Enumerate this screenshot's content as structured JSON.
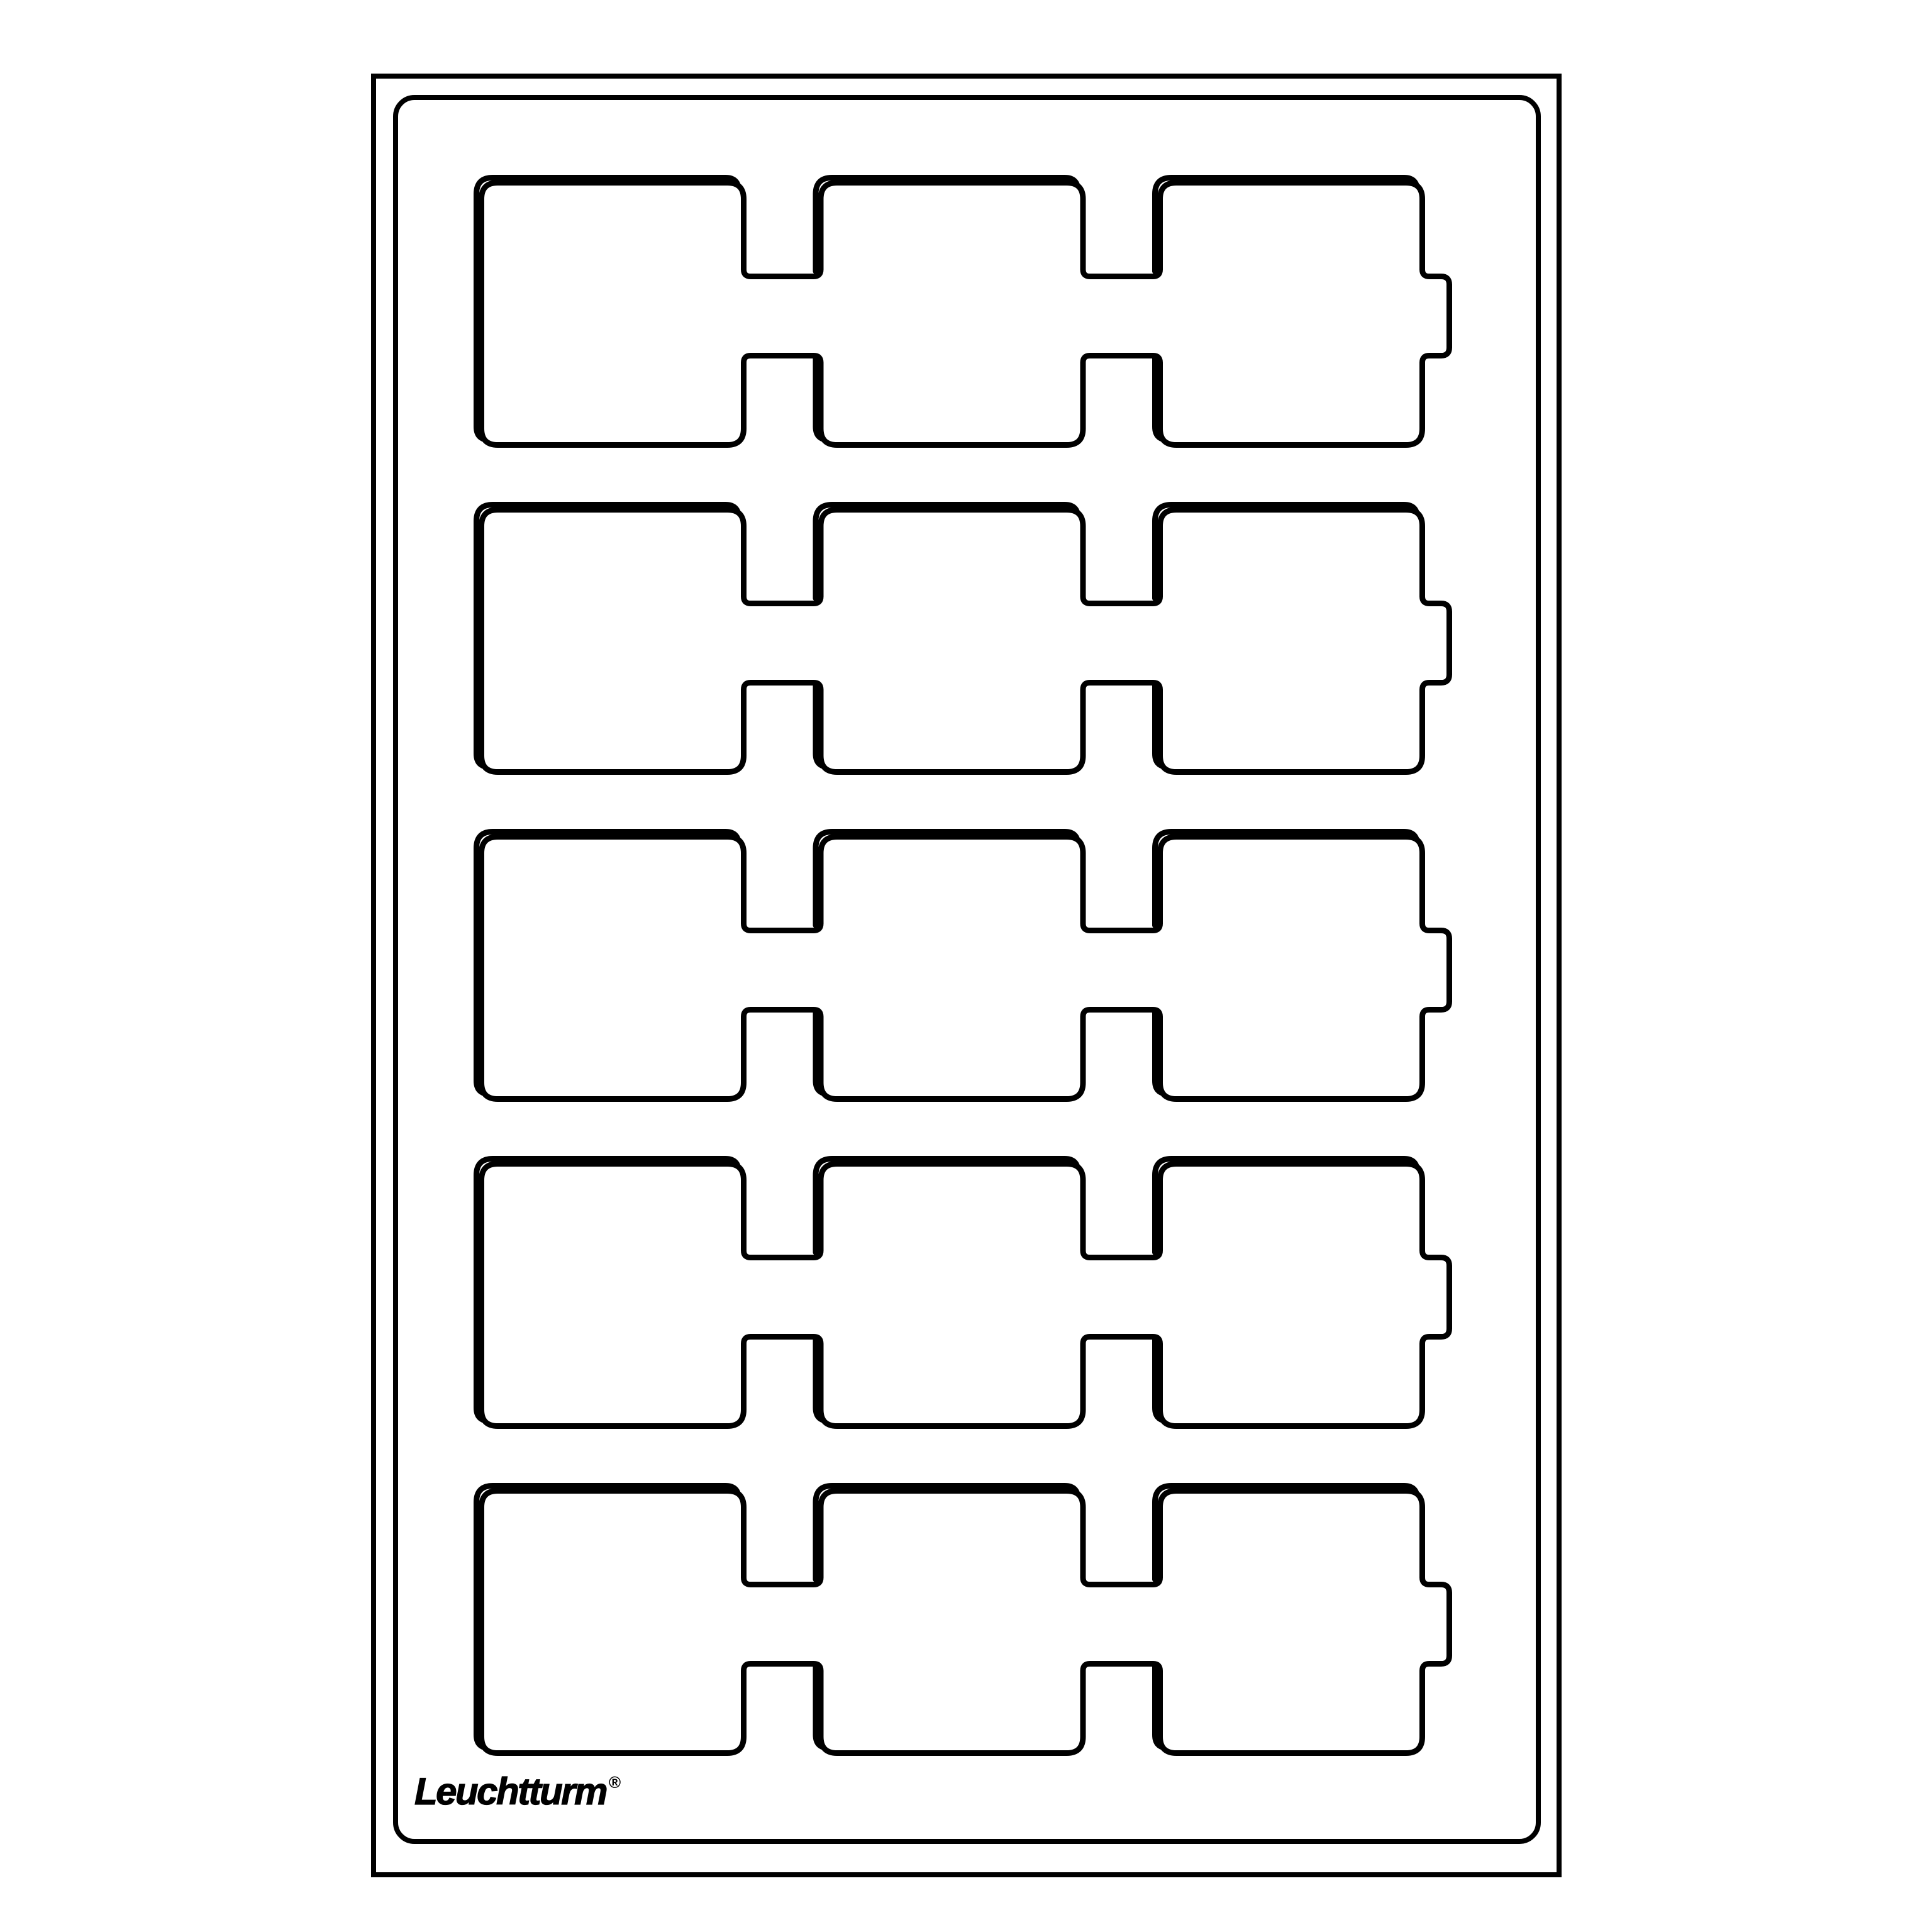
{
  "page": {
    "background_color": "#ffffff",
    "line_color": "#000000"
  },
  "brand": {
    "logo_text": "Leuchtturm",
    "registered_mark": "®"
  },
  "tray": {
    "rows": 5,
    "columns": 3,
    "compartments_total": 15,
    "compartment_shape": "square",
    "connector_channels_per_row": 2,
    "right_tab_per_row": 1
  }
}
